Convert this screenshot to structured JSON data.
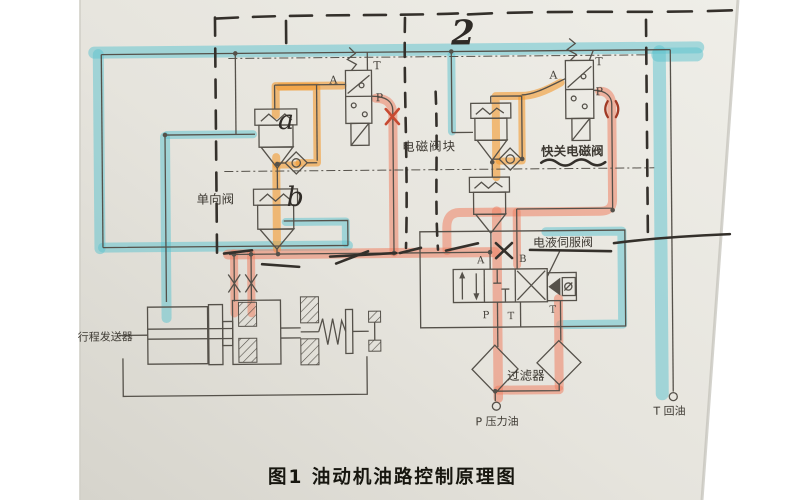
{
  "meta": {
    "caption": "图1 油动机油路控制原理图"
  },
  "labels": {
    "solenoid_block": "电磁阀块",
    "quick_close_solenoid": "快关电磁阀",
    "check_valve": "单向阀",
    "servo_valve": "电液伺服阀",
    "stroke_transmitter": "行程发送器",
    "filter": "过滤器",
    "pressure_oil": "P 压力油",
    "return_oil": "T 回油"
  },
  "handwritten": {
    "number": "2",
    "letter_a": "a",
    "letter_b": "b"
  },
  "ports": {
    "left_solenoid": {
      "a": "A",
      "t": "T",
      "p": "P"
    },
    "right_solenoid": {
      "a": "A",
      "t": "T",
      "p": "P"
    },
    "servo_valve": {
      "a": "A",
      "b": "B",
      "p": "P",
      "t": "T",
      "t2": "T"
    }
  },
  "colors": {
    "highlight_cyan": "#5fc4cf",
    "highlight_orange": "#f39a2e",
    "highlight_red": "#ef8164",
    "paper": "#e4e2db",
    "print_ink": "#55514a",
    "marker_ink": "#34302b"
  }
}
